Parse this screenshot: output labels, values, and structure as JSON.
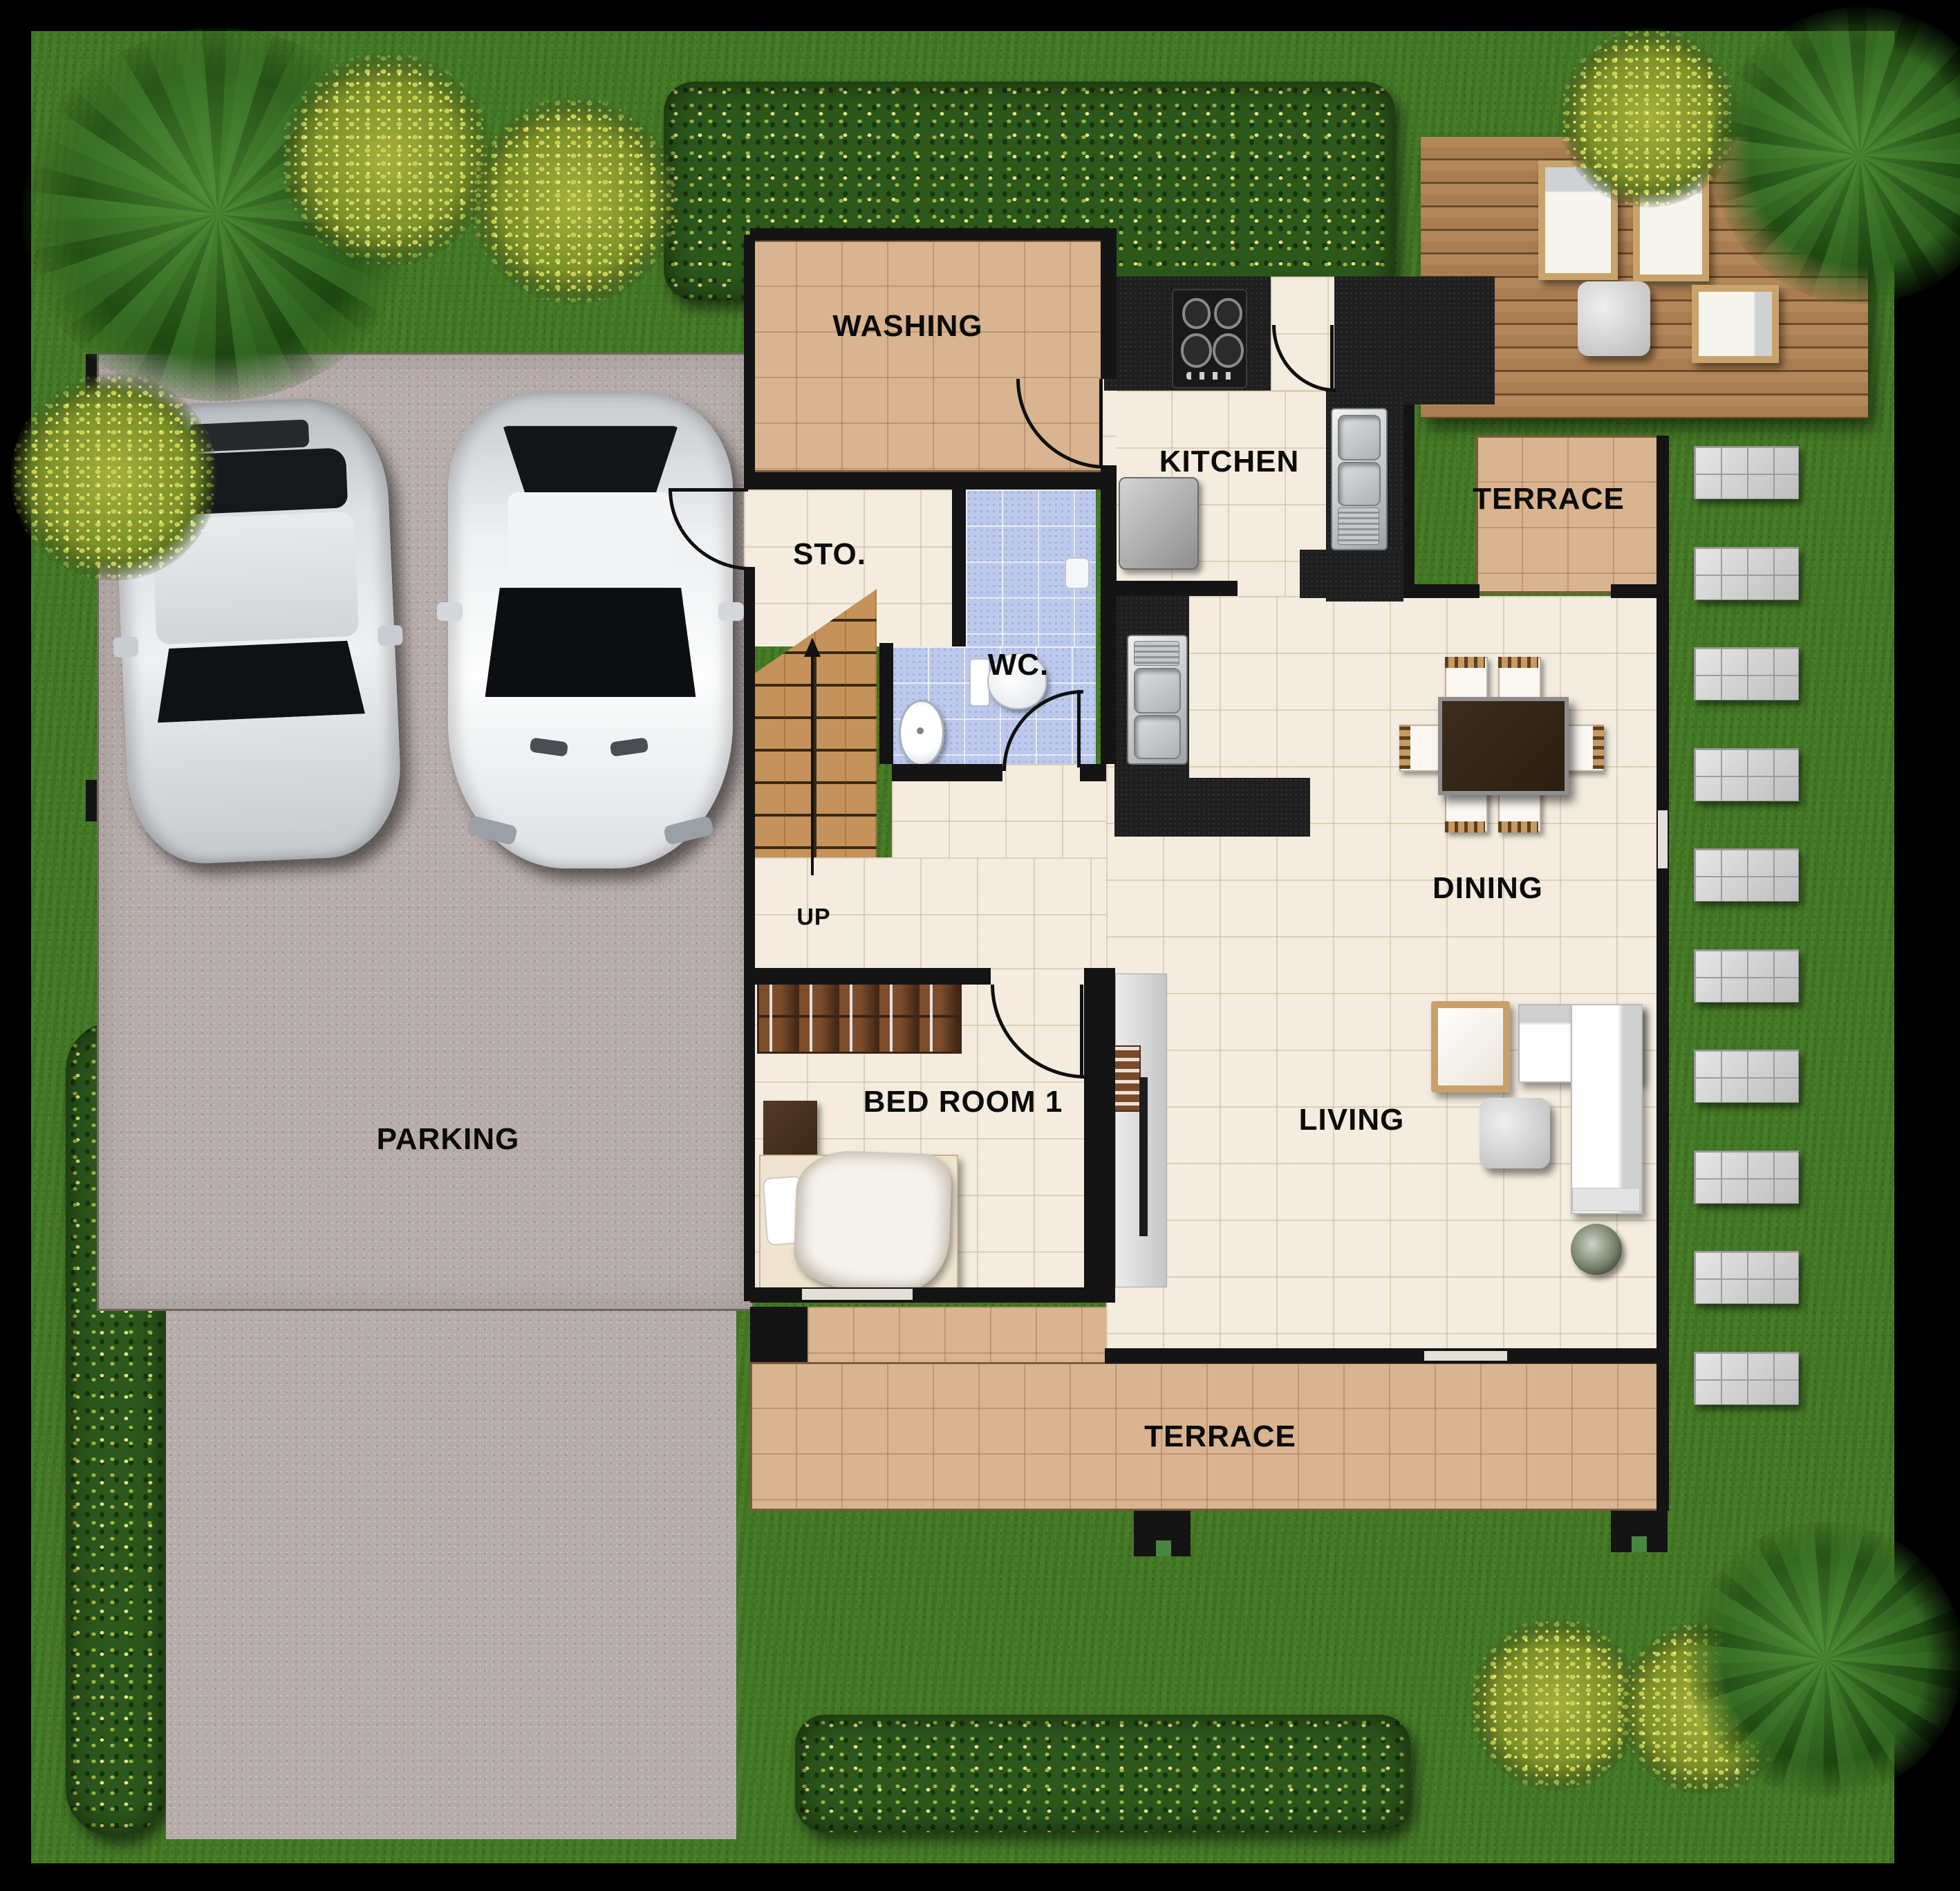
{
  "meta": {
    "type": "house floor plan",
    "view": "top-down site plan"
  },
  "labels": {
    "washing": "WASHING",
    "kitchen": "KITCHEN",
    "storage": "STO.",
    "wc": "WC.",
    "terrace_right": "TERRACE",
    "dining": "DINING",
    "living": "LIVING",
    "bedroom": "BED ROOM 1",
    "terrace_bottom": "TERRACE",
    "parking": "PARKING",
    "stairs_up": "UP"
  },
  "colors": {
    "background": "#000000",
    "grass": "#477c28",
    "floor_tan_tile": "#d8b490",
    "floor_cream_tile": "#f3ecdf",
    "floor_wc_blue": "#bdc9ec",
    "wood_deck": "#aa7d50",
    "wood_stairs": "#c6925b",
    "wall": "#141414",
    "parking_gravel": "#b6acaa",
    "stepping_stone": "#cecece",
    "label_text": "#0b0b0b"
  },
  "inventory": {
    "cars": 2,
    "stepping_stones": 10,
    "dining_chairs": 6,
    "deck_loungers": 3,
    "doors": 5,
    "dark_trees": 3,
    "yellow_bushes": 6,
    "hedges": 3,
    "sinks": 2,
    "bedrooms_labeled": 1
  }
}
